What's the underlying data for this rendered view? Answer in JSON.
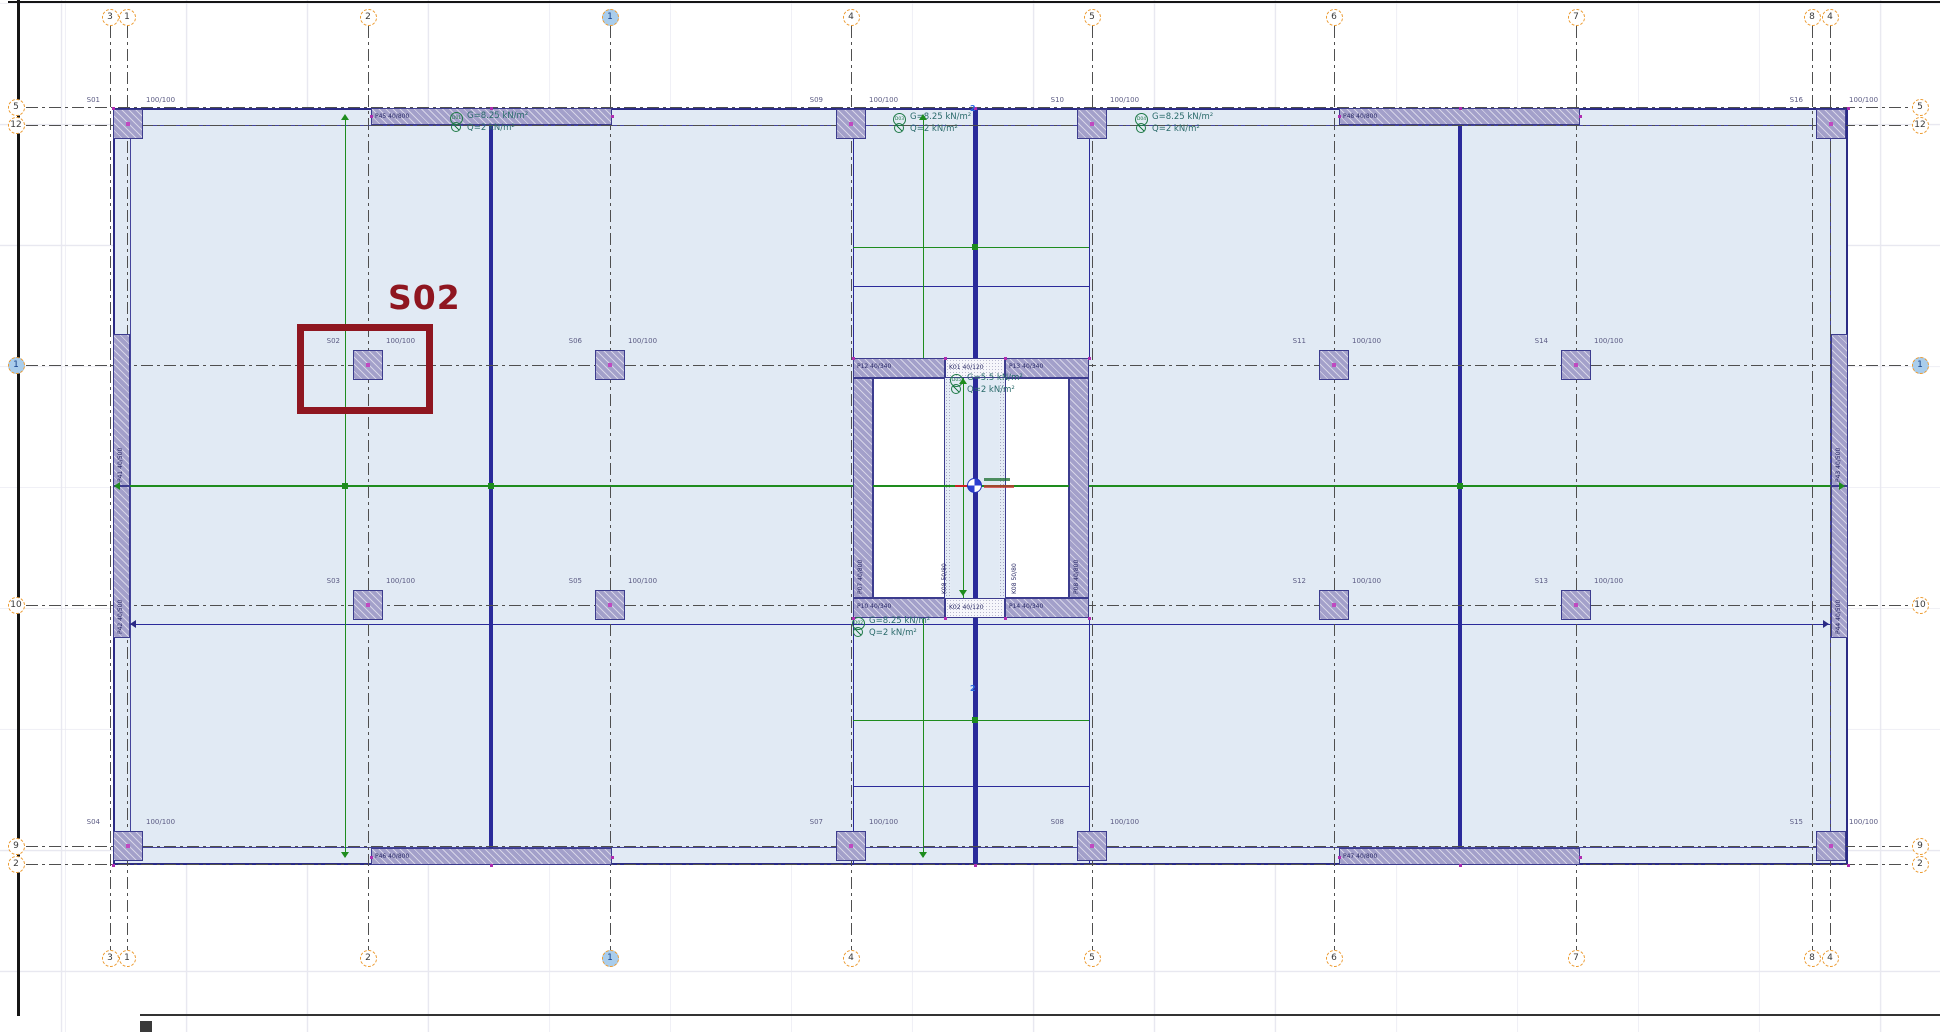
{
  "app": {
    "view": "structural-floor-plan"
  },
  "highlight": {
    "label": "S02",
    "color": "#8f1620",
    "rect": {
      "x": 297,
      "y": 324,
      "w": 136,
      "h": 90
    },
    "label_x": 388,
    "label_y": 278
  },
  "plan": {
    "x": 113,
    "y": 108,
    "w": 1735,
    "h": 757,
    "slab_color": "#e1eaf4",
    "beam_color": "#2b2b85",
    "green_color": "#1e8c1e"
  },
  "axes": {
    "vertical": [
      {
        "label": "3",
        "x": 110,
        "selected": false
      },
      {
        "label": "1",
        "x": 127,
        "selected": false
      },
      {
        "label": "2",
        "x": 368,
        "selected": false
      },
      {
        "label": "1",
        "x": 610,
        "selected": true
      },
      {
        "label": "4",
        "x": 851,
        "selected": false
      },
      {
        "label": "5",
        "x": 1092,
        "selected": false
      },
      {
        "label": "6",
        "x": 1334,
        "selected": false
      },
      {
        "label": "7",
        "x": 1576,
        "selected": false
      },
      {
        "label": "8",
        "x": 1812,
        "selected": false
      },
      {
        "label": "4",
        "x": 1830,
        "selected": false
      }
    ],
    "horizontal": [
      {
        "label": "5",
        "y": 107,
        "selected": false
      },
      {
        "label": "12",
        "y": 125,
        "selected": false
      },
      {
        "label": "1",
        "y": 365,
        "selected": true
      },
      {
        "label": "10",
        "y": 605,
        "selected": false
      },
      {
        "label": "9",
        "y": 846,
        "selected": false
      },
      {
        "label": "2",
        "y": 864,
        "selected": false
      }
    ]
  },
  "columns": [
    {
      "id": "S01",
      "dim": "100/100",
      "x": 128,
      "y": 124
    },
    {
      "id": "S09",
      "dim": "100/100",
      "x": 851,
      "y": 124
    },
    {
      "id": "S10",
      "dim": "100/100",
      "x": 1092,
      "y": 124
    },
    {
      "id": "S16",
      "dim": "100/100",
      "x": 1831,
      "y": 124
    },
    {
      "id": "S02",
      "dim": "100/100",
      "x": 368,
      "y": 365
    },
    {
      "id": "S06",
      "dim": "100/100",
      "x": 610,
      "y": 365
    },
    {
      "id": "S11",
      "dim": "100/100",
      "x": 1334,
      "y": 365
    },
    {
      "id": "S14",
      "dim": "100/100",
      "x": 1576,
      "y": 365
    },
    {
      "id": "S03",
      "dim": "100/100",
      "x": 368,
      "y": 605
    },
    {
      "id": "S05",
      "dim": "100/100",
      "x": 610,
      "y": 605
    },
    {
      "id": "S12",
      "dim": "100/100",
      "x": 1334,
      "y": 605
    },
    {
      "id": "S13",
      "dim": "100/100",
      "x": 1576,
      "y": 605
    },
    {
      "id": "S04",
      "dim": "100/100",
      "x": 128,
      "y": 846
    },
    {
      "id": "S07",
      "dim": "100/100",
      "x": 851,
      "y": 846
    },
    {
      "id": "S08",
      "dim": "100/100",
      "x": 1092,
      "y": 846
    },
    {
      "id": "S15",
      "dim": "100/100",
      "x": 1831,
      "y": 846
    }
  ],
  "walls": [
    {
      "id": "P45 40/800",
      "x": 371,
      "y": 108,
      "w": 241,
      "h": 17,
      "rot": false
    },
    {
      "id": "P48 40/800",
      "x": 1339,
      "y": 108,
      "w": 241,
      "h": 17,
      "rot": false
    },
    {
      "id": "P46 40/800",
      "x": 371,
      "y": 848,
      "w": 241,
      "h": 17,
      "rot": false
    },
    {
      "id": "P47 40/800",
      "x": 1339,
      "y": 848,
      "w": 241,
      "h": 17,
      "rot": false
    },
    {
      "id": "P41 40/500",
      "x": 113,
      "y": 334,
      "w": 17,
      "h": 152,
      "rot": true
    },
    {
      "id": "P42 40/500",
      "x": 113,
      "y": 486,
      "w": 17,
      "h": 152,
      "rot": true
    },
    {
      "id": "P43 40/500",
      "x": 1831,
      "y": 334,
      "w": 17,
      "h": 152,
      "rot": true
    },
    {
      "id": "P44 40/500",
      "x": 1831,
      "y": 486,
      "w": 17,
      "h": 152,
      "rot": true
    },
    {
      "id": "P12 40/340",
      "x": 853,
      "y": 358,
      "w": 92,
      "h": 20,
      "rot": false
    },
    {
      "id": "P13 40/340",
      "x": 1005,
      "y": 358,
      "w": 84,
      "h": 20,
      "rot": false
    },
    {
      "id": "P10 40/340",
      "x": 853,
      "y": 598,
      "w": 92,
      "h": 20,
      "rot": false
    },
    {
      "id": "P14 40/340",
      "x": 1005,
      "y": 598,
      "w": 84,
      "h": 20,
      "rot": false
    },
    {
      "id": "P07 40/800",
      "x": 853,
      "y": 378,
      "w": 20,
      "h": 220,
      "rot": true
    },
    {
      "id": "P08 40/800",
      "x": 1069,
      "y": 378,
      "w": 20,
      "h": 220,
      "rot": true
    }
  ],
  "core_beams": [
    {
      "id": "K01 40/120",
      "x": 945,
      "y": 358,
      "w": 60,
      "h": 20
    },
    {
      "id": "K02 40/120",
      "x": 945,
      "y": 598,
      "w": 60,
      "h": 20
    }
  ],
  "small_labels": [
    {
      "text": "K08 50/80",
      "x": 941,
      "y": 594,
      "rot": true
    },
    {
      "text": "K08 50/80",
      "x": 1011,
      "y": 594,
      "rot": true
    }
  ],
  "marks": [
    {
      "text": "2",
      "x": 970,
      "y": 104
    },
    {
      "text": "2",
      "x": 970,
      "y": 684
    }
  ],
  "loads": [
    {
      "id": "D01",
      "g": "G=8.25 kN/m²",
      "q": "Q=2 kN/m²",
      "x": 450,
      "y": 112
    },
    {
      "id": "D03",
      "g": "G=8.25 kN/m²",
      "q": "Q=2 kN/m²",
      "x": 893,
      "y": 113
    },
    {
      "id": "D04",
      "g": "G=8.25 kN/m²",
      "q": "Q=2 kN/m²",
      "x": 1135,
      "y": 113
    },
    {
      "id": "D05",
      "g": "G=5.5 kN/m²",
      "q": "Q=2 kN/m²",
      "x": 950,
      "y": 374
    },
    {
      "id": "D02",
      "g": "G=8.25 kN/m²",
      "q": "Q=2 kN/m²",
      "x": 852,
      "y": 617
    }
  ],
  "navy_lines": [
    {
      "x1": 491,
      "y1": 108,
      "x2": 491,
      "y2": 865,
      "t": 4
    },
    {
      "x1": 975,
      "y1": 108,
      "x2": 975,
      "y2": 865,
      "t": 5
    },
    {
      "x1": 1460,
      "y1": 108,
      "x2": 1460,
      "y2": 865,
      "t": 4
    },
    {
      "x1": 853,
      "y1": 108,
      "x2": 853,
      "y2": 358,
      "t": 1
    },
    {
      "x1": 853,
      "y1": 618,
      "x2": 853,
      "y2": 865,
      "t": 1
    },
    {
      "x1": 1089,
      "y1": 108,
      "x2": 1089,
      "y2": 358,
      "t": 1
    },
    {
      "x1": 1089,
      "y1": 618,
      "x2": 1089,
      "y2": 865,
      "t": 1
    },
    {
      "x1": 853,
      "y1": 286,
      "x2": 1089,
      "y2": 286,
      "t": 1
    },
    {
      "x1": 853,
      "y1": 786,
      "x2": 1089,
      "y2": 786,
      "t": 1
    },
    {
      "x1": 130,
      "y1": 624,
      "x2": 1831,
      "y2": 624,
      "t": 1
    }
  ],
  "green_lines": [
    {
      "x1": 345,
      "y1": 120,
      "x2": 345,
      "y2": 857,
      "t": 1
    },
    {
      "x1": 923,
      "y1": 120,
      "x2": 923,
      "y2": 360,
      "t": 1
    },
    {
      "x1": 923,
      "y1": 616,
      "x2": 923,
      "y2": 857,
      "t": 1
    },
    {
      "x1": 963,
      "y1": 378,
      "x2": 963,
      "y2": 598,
      "t": 1
    },
    {
      "x1": 113,
      "y1": 486,
      "x2": 1848,
      "y2": 486,
      "t": 2
    },
    {
      "x1": 853,
      "y1": 247,
      "x2": 1089,
      "y2": 247,
      "t": 1
    },
    {
      "x1": 853,
      "y1": 720,
      "x2": 1089,
      "y2": 720,
      "t": 1
    }
  ],
  "green_squares": [
    [
      491,
      486
    ],
    [
      1460,
      486
    ],
    [
      975,
      247
    ],
    [
      975,
      720
    ],
    [
      345,
      486
    ]
  ],
  "arrows": [
    {
      "x": 345,
      "y": 118,
      "dir": "up",
      "c": "#1e8c1e"
    },
    {
      "x": 345,
      "y": 856,
      "dir": "down",
      "c": "#1e8c1e"
    },
    {
      "x": 923,
      "y": 118,
      "dir": "up",
      "c": "#1e8c1e"
    },
    {
      "x": 923,
      "y": 856,
      "dir": "down",
      "c": "#1e8c1e"
    },
    {
      "x": 963,
      "y": 382,
      "dir": "up",
      "c": "#1e8c1e"
    },
    {
      "x": 963,
      "y": 594,
      "dir": "down",
      "c": "#1e8c1e"
    },
    {
      "x": 118,
      "y": 486,
      "dir": "left",
      "c": "#1e8c1e"
    },
    {
      "x": 1843,
      "y": 486,
      "dir": "right",
      "c": "#1e8c1e"
    },
    {
      "x": 134,
      "y": 624,
      "dir": "left",
      "c": "#2b2b85"
    },
    {
      "x": 1827,
      "y": 624,
      "dir": "right",
      "c": "#2b2b85"
    }
  ],
  "magenta_dots": [
    [
      113,
      108
    ],
    [
      1848,
      108
    ],
    [
      113,
      865
    ],
    [
      1848,
      865
    ],
    [
      491,
      108
    ],
    [
      975,
      108
    ],
    [
      1460,
      108
    ],
    [
      491,
      865
    ],
    [
      975,
      865
    ],
    [
      1460,
      865
    ],
    [
      371,
      116
    ],
    [
      612,
      116
    ],
    [
      1339,
      116
    ],
    [
      1580,
      116
    ],
    [
      371,
      857
    ],
    [
      612,
      857
    ],
    [
      1339,
      857
    ],
    [
      1580,
      857
    ],
    [
      853,
      358
    ],
    [
      945,
      358
    ],
    [
      1005,
      358
    ],
    [
      1089,
      358
    ],
    [
      853,
      618
    ],
    [
      945,
      618
    ],
    [
      1005,
      618
    ],
    [
      1089,
      618
    ]
  ]
}
